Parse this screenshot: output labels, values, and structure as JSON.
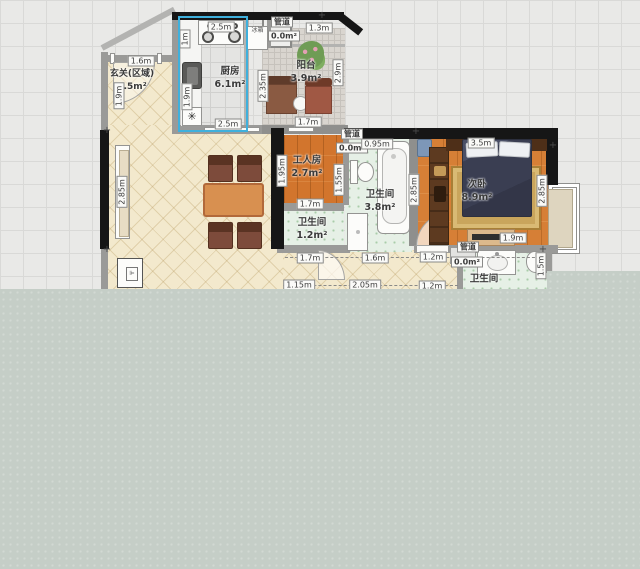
{
  "rooms": {
    "kitchen": {
      "name": "厨房",
      "area": "6.1m²"
    },
    "entrance": {
      "name": "玄关(区域)",
      "area": "2.5m²"
    },
    "balcony": {
      "name": "阳台",
      "area": "3.9m²"
    },
    "duct_top": {
      "name": "管道",
      "area": "0.0m²"
    },
    "duct_mid": {
      "name": "管道",
      "area": "0.0m²"
    },
    "duct_bottom": {
      "name": "管道",
      "area": "0.0m²"
    },
    "worker_room": {
      "name": "工人房",
      "area": "2.7m²"
    },
    "bathroom_main": {
      "name": "卫生间",
      "area": "3.8m²"
    },
    "bathroom_small": {
      "name": "卫生间",
      "area": "1.2m²"
    },
    "bathroom_bottom": {
      "name": "卫生间"
    },
    "bedroom": {
      "name": "次卧",
      "area": "8.9m²"
    }
  },
  "fixtures": {
    "fridge_label": "冰箱",
    "fan_symbol": "✳"
  },
  "dims": {
    "kitchen_top": "2.5m",
    "kitchen_bottom": "2.5m",
    "kitchen_left_upper": "1m",
    "kitchen_left_lower": "1.9m",
    "kitchen_right": "2.35m",
    "balcony_top": "1.3m",
    "balcony_right": "2.9m",
    "balcony_bottom": "1.7m",
    "entrance_top": "1.6m",
    "entrance_left": "1.9m",
    "living_window": "2.85m",
    "worker_left": "1.95m",
    "worker_right": "1.55m",
    "worker_bottom": "1.7m",
    "duct_mid_width": "0.95m",
    "bath_bedroom_wall": "2.85m",
    "bedroom_top": "3.5m",
    "bedroom_right": "2.85m",
    "bedroom_bottom": "1.9m",
    "hall_row1": [
      "1.7m",
      "1.6m",
      "1.2m"
    ],
    "hall_row2": [
      "1.15m",
      "2.05m",
      "1.2m"
    ],
    "bath_bottom_right": "1.5m"
  },
  "colors": {
    "selection": "#3fb0dc",
    "wall": "#161616",
    "wood_floor": "#d2752d",
    "overlay": "#c5cec7"
  }
}
